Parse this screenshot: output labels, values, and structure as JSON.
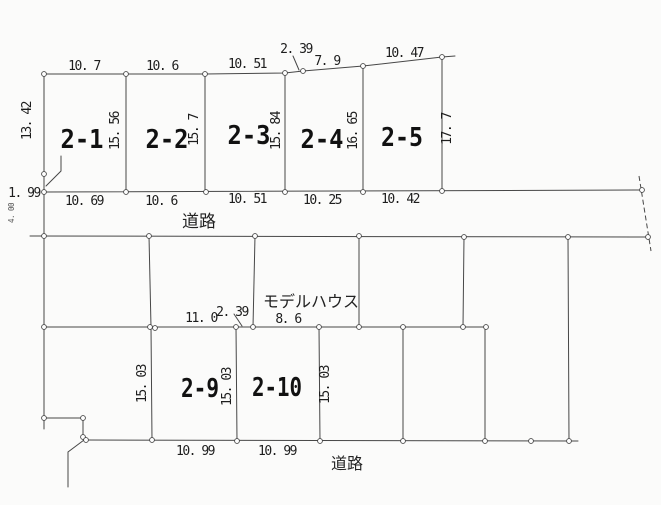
{
  "document": {
    "type": "land-subdivision-plan",
    "upper_block": {
      "plots": [
        "2-1",
        "2-2",
        "2-3",
        "2-4",
        "2-5"
      ],
      "top_dims": [
        "10. 7",
        "10. 6",
        "10. 51",
        "2. 39",
        "7. 9",
        "10. 47"
      ],
      "bottom_dims": [
        "10. 69",
        "10. 6",
        "10. 51",
        "10. 25",
        "10. 42"
      ],
      "left_dims": [
        "13. 42",
        "1. 99"
      ],
      "depth_dims": [
        "15. 56",
        "15. 7",
        "15. 84",
        "16. 65",
        "17. 7"
      ]
    },
    "upper_road": {
      "label": "道路",
      "width_dim": "4. 00"
    },
    "middle_block": {
      "model_house_label": "モデルハウス",
      "frontage_dims": [
        "11. 0",
        "2. 39",
        "8. 6"
      ]
    },
    "lower_block": {
      "plots": [
        "2-9",
        "2-10"
      ],
      "depth_dims": [
        "15. 03",
        "15. 03",
        "15. 03"
      ],
      "bottom_dims": [
        "10. 99",
        "10. 99"
      ]
    },
    "lower_road": {
      "label": "道路"
    }
  },
  "colors": {
    "ink": "#474747",
    "paper": "#fbfbfa"
  }
}
